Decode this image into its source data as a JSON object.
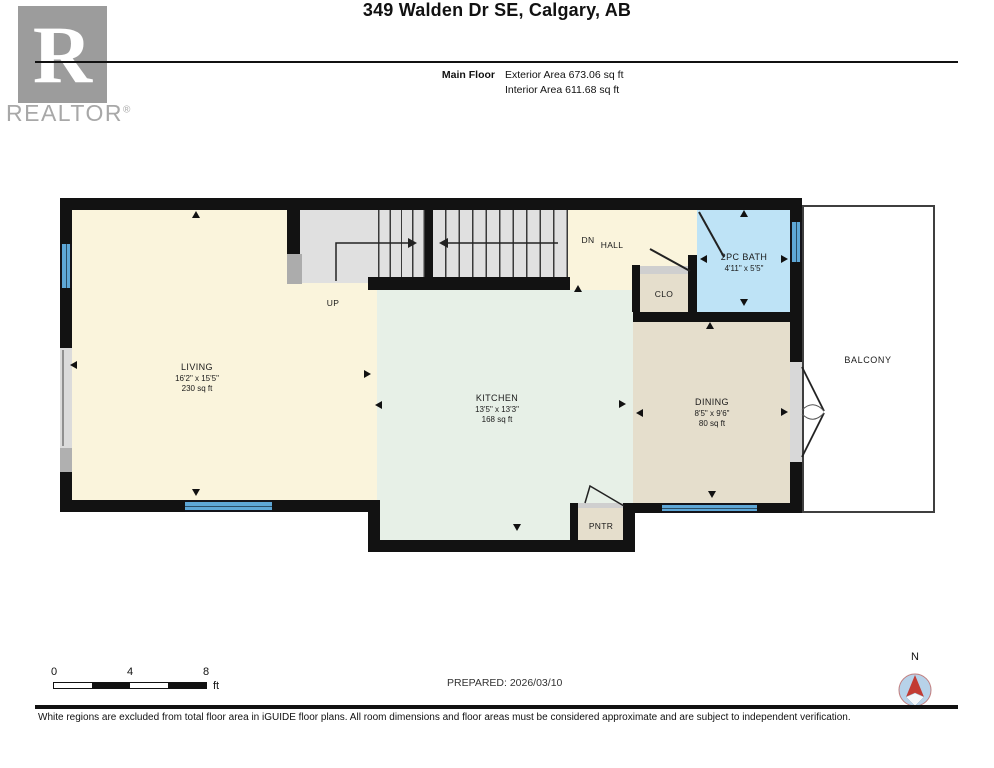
{
  "header": {
    "title": "349 Walden Dr SE, Calgary, AB",
    "floor_label": "Main Floor",
    "exterior_area": "Exterior Area 673.06 sq ft",
    "interior_area": "Interior Area 611.68 sq ft"
  },
  "branding": {
    "logo_letter": "R",
    "logo_text": "REALTOR",
    "registered": "®"
  },
  "rooms": {
    "living": {
      "name": "LIVING",
      "dims": "16'2\" x 15'5\"",
      "area": "230 sq ft"
    },
    "kitchen": {
      "name": "KITCHEN",
      "dims": "13'5\" x 13'3\"",
      "area": "168 sq ft"
    },
    "dining": {
      "name": "DINING",
      "dims": "8'5\" x 9'6\"",
      "area": "80 sq ft"
    },
    "bath": {
      "name": "2PC BATH",
      "dims": "4'11\" x 5'5\""
    },
    "closet": {
      "name": "CLO"
    },
    "pantry": {
      "name": "PNTR"
    },
    "hall": {
      "name": "HALL"
    },
    "balcony": {
      "name": "BALCONY"
    }
  },
  "stairs": {
    "up_label": "UP",
    "down_label": "DN"
  },
  "scale_bar": {
    "t0": "0",
    "t4": "4",
    "t8": "8",
    "unit": "ft"
  },
  "compass": {
    "north": "N"
  },
  "footer": {
    "prepared": "PREPARED: 2026/03/10",
    "disclaimer": "White regions are excluded from total floor area in iGUIDE floor plans. All room dimensions and floor areas must be considered approximate and are subject to independent verification."
  },
  "colors": {
    "wall": "#121212",
    "living_fill": "#FAF4DC",
    "kitchen_fill": "#E7F0E7",
    "dining_fill": "#E5DECC",
    "bath_fill": "#BEE3F6",
    "window_blue": "#5EA7D6",
    "stair_gray": "#E0E0E0",
    "compass_red": "#C23B33"
  }
}
